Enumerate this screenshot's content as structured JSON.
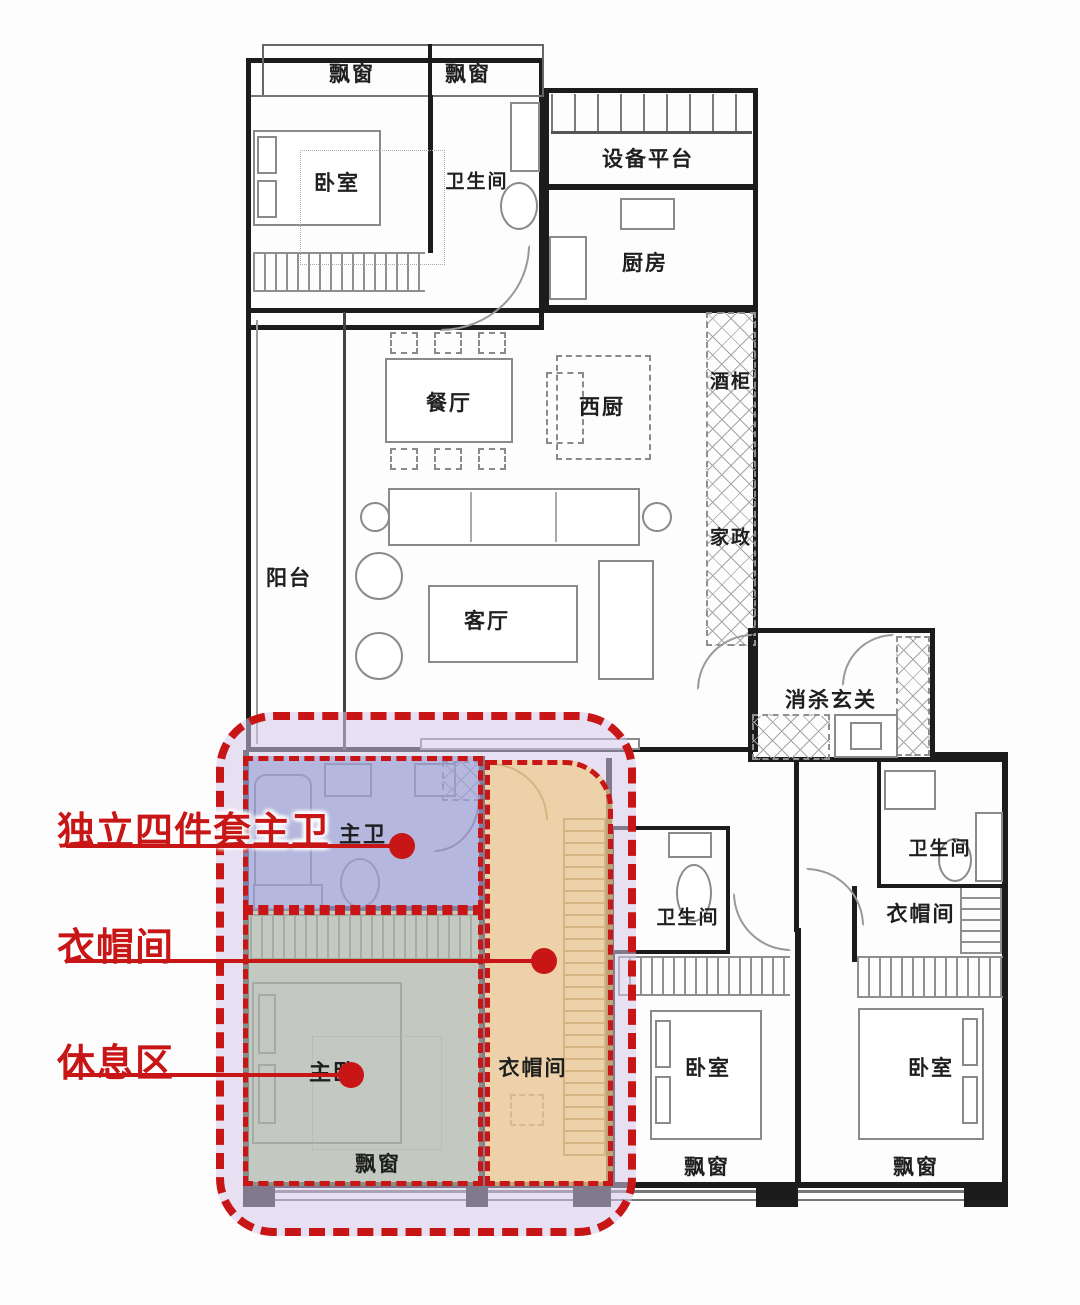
{
  "rooms": {
    "bay_tl_1": "飘窗",
    "bay_tl_2": "飘窗",
    "bedroom_tl": "卧室",
    "bath_tl": "卫生间",
    "equipment": "设备平台",
    "kitchen": "厨房",
    "dining": "餐厅",
    "west_kitchen": "西厨",
    "wine_cabinet": "酒柜",
    "housekeeping": "家政",
    "balcony": "阳台",
    "living": "客厅",
    "entry": "消杀玄关",
    "master_bath": "主卫",
    "bath_mid": "卫生间",
    "bath_right": "卫生间",
    "cloak_right": "衣帽间",
    "master_bed": "主卧",
    "cloak_master": "衣帽间",
    "bedroom_mid": "卧室",
    "bedroom_right": "卧室",
    "bay_master": "飘窗",
    "bay_mid": "飘窗",
    "bay_right": "飘窗"
  },
  "callouts": [
    {
      "label": "独立四件套主卫"
    },
    {
      "label": "衣帽间"
    },
    {
      "label": "休息区"
    }
  ],
  "colors": {
    "red": "#c81515",
    "purple": "#e7e0f1",
    "blue": "#b7bddd",
    "green": "#ccd6c5",
    "orange": "#f2d9a9",
    "wall": "#1c1c1c"
  }
}
